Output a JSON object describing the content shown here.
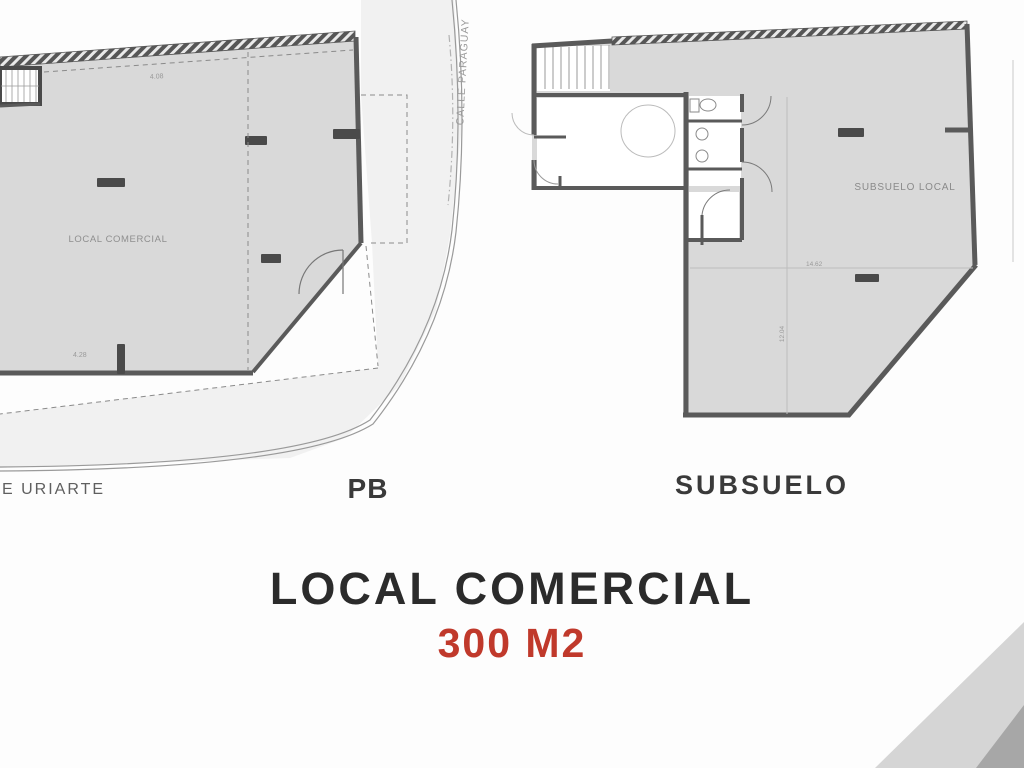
{
  "pb_plan": {
    "room_label": "LOCAL COMERCIAL",
    "dim_top": "4.08",
    "dim_bottom": "4.28",
    "floor_label": "PB",
    "street_bottom": "E URIARTE",
    "street_right": "CALLE PARAGUAY"
  },
  "subsuelo_plan": {
    "room_label": "SUBSUELO LOCAL",
    "dim_horizontal": "14.62",
    "dim_vertical": "12.04",
    "floor_label": "SUBSUELO"
  },
  "title": {
    "name": "LOCAL COMERCIAL",
    "area": "300 M2"
  },
  "colors": {
    "plan_fill": "#d9d9d9",
    "wall": "#5a5a5a",
    "title_text": "#2b2b2b",
    "area_accent": "#c0392b",
    "corner_light": "#d5d5d5",
    "corner_dark": "#a7a7a7"
  }
}
